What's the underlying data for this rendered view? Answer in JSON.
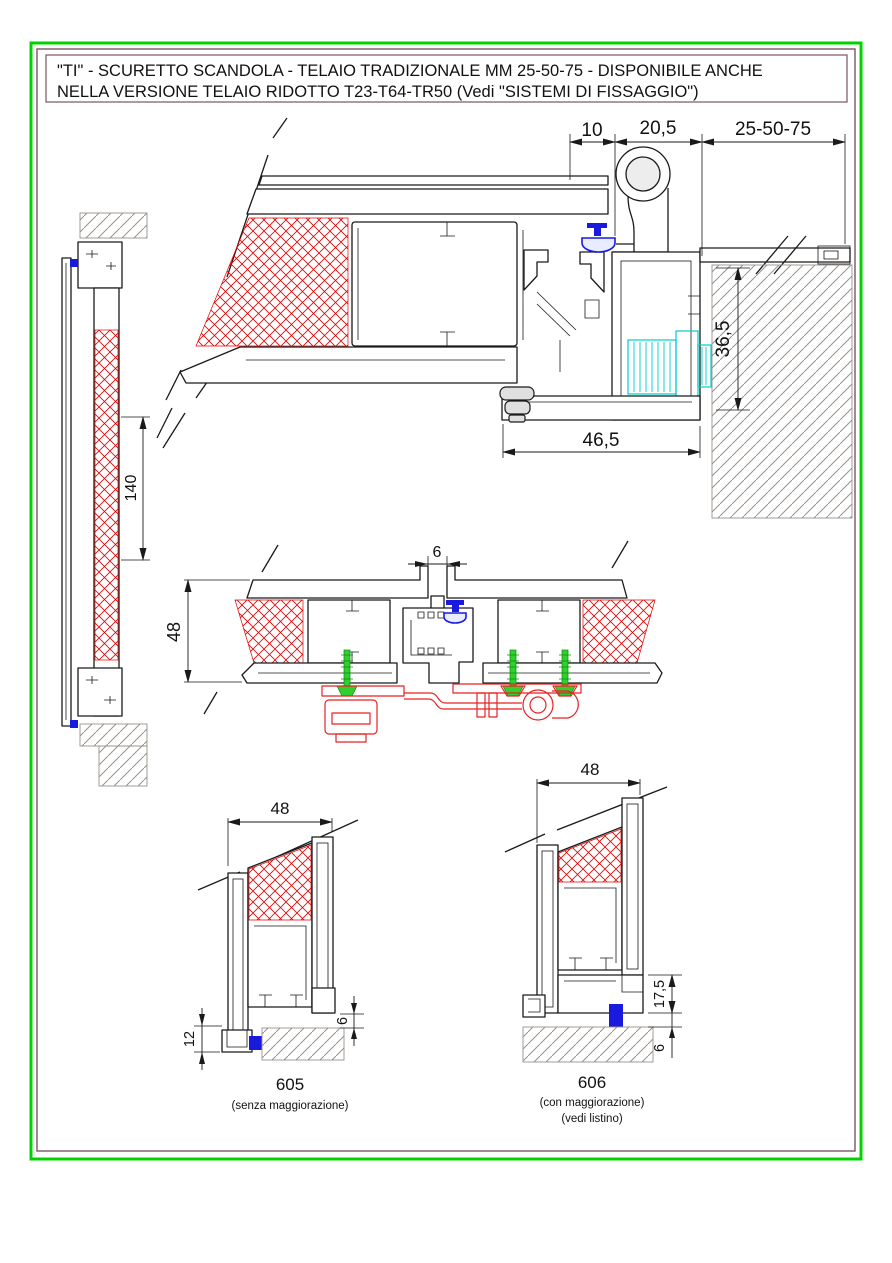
{
  "title": {
    "line1": "\"TI\" - SCURETTO SCANDOLA - TELAIO TRADIZIONALE MM 25-50-75 - DISPONIBILE ANCHE",
    "line2": "NELLA VERSIONE TELAIO RIDOTTO T23-T64-TR50 (Vedi \"SISTEMI DI FISSAGGIO\")"
  },
  "main_section": {
    "dim_cover": "10",
    "dim_hinge": "20,5",
    "dim_frame_options": "25-50-75",
    "dim_anchor_height": "36,5",
    "dim_total_depth": "46,5"
  },
  "side_section": {
    "dim_panel_height": "140"
  },
  "center_section": {
    "dim_gap": "6",
    "dim_depth": "48"
  },
  "detail_605": {
    "label": "605",
    "caption": "(senza maggiorazione)",
    "dim_width": "48",
    "dim_shoe_height": "12",
    "dim_floor_gap": "6"
  },
  "detail_606": {
    "label": "606",
    "caption1": "(con maggiorazione)",
    "caption2": "(vedi listino)",
    "dim_width": "48",
    "dim_addon_height": "17,5",
    "dim_floor_gap": "6"
  },
  "colors": {
    "outer_border_green": "#00d400",
    "inner_border_maroon": "#7a5560",
    "panel_hatch_red": "#e60000",
    "wall_hatch_gray": "#9a918a",
    "anchor_cyan": "#00cccc",
    "screw_green": "#2fd02f",
    "hardware_red": "#e82222",
    "gasket_blue": "#1a1adf",
    "line_black": "#1a1a1a"
  }
}
